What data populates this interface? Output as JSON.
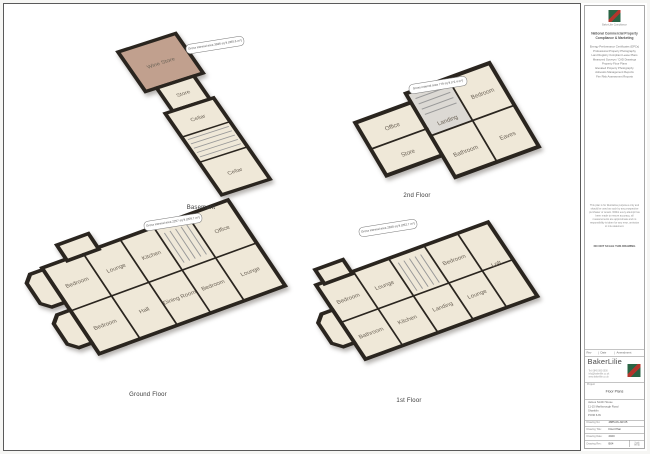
{
  "side_panel": {
    "logo_caption": "BakerLilie Compliance",
    "header_line1": "National Commercial Property",
    "header_line2": "Compliance & Marketing",
    "services": [
      "Energy Performance Certificates (EPCs)",
      "Professional Property Photography",
      "Land Registry Compliant Lease Plans",
      "Measured Surveys / CAD Drawings",
      "Property Floor Plans",
      "Elevated Property Photography",
      "Asbestos Management Reports",
      "Fire Risk Assessment Reports"
    ],
    "disclaimer": "This plan is for illustrative purposes only and should be used as such by any prospective purchaser or tenant. Whilst every attempt has been made to ensure accuracy, all measurements are approximate and no responsibility is taken for any error, omission or mis-statement.",
    "do_not_scale": "DO NOT SCALE THIS DRAWING",
    "amendments_header": {
      "rev": "Rev",
      "date": "Date",
      "amendment": "Amendment"
    },
    "company": {
      "name": "BakerLilie",
      "contact_lines": [
        "Tel: 0845 000 0000",
        "info@bakerlilie.co.uk",
        "www.bakerlilie.co.uk"
      ]
    },
    "project_label": "Project",
    "project_name": "Floor Plans",
    "address_lines": [
      "James Smith House",
      "11-15 Marlborough Road",
      "Shanklin",
      "PO36 6JN"
    ],
    "fields": [
      {
        "label": "Drawing No:",
        "value": "4885-06-JW-05"
      },
      {
        "label": "Drawing Title:",
        "value": "Floor Plan"
      },
      {
        "label": "Drawing Date:",
        "value": "2020"
      },
      {
        "label": "Drawing Rev:",
        "value": "B04"
      }
    ],
    "scale_box": {
      "label": "Scale",
      "value": "NTS"
    }
  },
  "floors": [
    {
      "name": "Basement",
      "area_label": "Gross internal area 3936 sq ft (365.6 m²)",
      "rooms": [
        {
          "name": "Wine Store"
        },
        {
          "name": "Store"
        },
        {
          "name": "Cellar"
        },
        {
          "name": "Cellar"
        }
      ]
    },
    {
      "name": "2nd Floor",
      "area_label": "Gross internal area 779 sq ft (72.4 m²)",
      "rooms": [
        {
          "name": "Office"
        },
        {
          "name": "Store"
        },
        {
          "name": "Landing"
        },
        {
          "name": "Bedroom"
        },
        {
          "name": "Bathroom"
        },
        {
          "name": "Eaves"
        }
      ]
    },
    {
      "name": "Ground Floor",
      "area_label": "Gross internal area 2257 sq ft (209.7 m²)",
      "rooms": [
        {
          "name": "Bedroom"
        },
        {
          "name": "Bedroom"
        },
        {
          "name": "Lounge"
        },
        {
          "name": "Hall"
        },
        {
          "name": "Kitchen"
        },
        {
          "name": "Dining Room"
        },
        {
          "name": "Bedroom"
        },
        {
          "name": "Office"
        },
        {
          "name": "Lounge"
        }
      ]
    },
    {
      "name": "1st Floor",
      "area_label": "Gross internal area 2828 sq ft (262.7 m²)",
      "rooms": [
        {
          "name": "Bedroom"
        },
        {
          "name": "Bathroom"
        },
        {
          "name": "Lounge"
        },
        {
          "name": "Kitchen"
        },
        {
          "name": "Landing"
        },
        {
          "name": "Bedroom"
        },
        {
          "name": "Lounge"
        },
        {
          "name": "Loft"
        }
      ]
    }
  ]
}
